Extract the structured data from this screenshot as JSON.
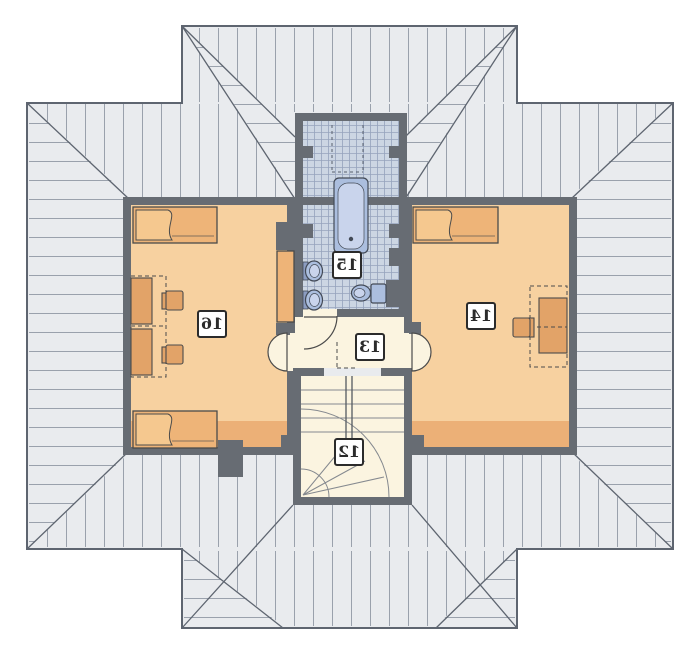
{
  "rooms": [
    {
      "number": "12"
    },
    {
      "number": "13"
    },
    {
      "number": "14"
    },
    {
      "number": "15"
    },
    {
      "number": "16"
    }
  ],
  "colors": {
    "bg": "#ffffff",
    "roof_fill": "#e9ebee",
    "roof_hatch": "#9aa1ac",
    "roof_outline": "#5e6570",
    "wall": "#676c73",
    "room_floor": "#f7d1a0",
    "knee_strip": "#ecb077",
    "corridor_floor": "#fbf4e0",
    "tile_fill": "#ccd6e3",
    "tile_grid": "#96a3bd",
    "fixture_blue": "#abbede",
    "fixture_inner": "#c9d4ec",
    "fixture_dark": "#8b9cc0",
    "fixture_stroke": "#434a56",
    "furniture_orange": "#eeb478",
    "furniture_mid": "#e2a368",
    "pillow": "#f5c88f",
    "furn_stroke": "#4b4b4b",
    "label_text": "#2b2b2b"
  }
}
